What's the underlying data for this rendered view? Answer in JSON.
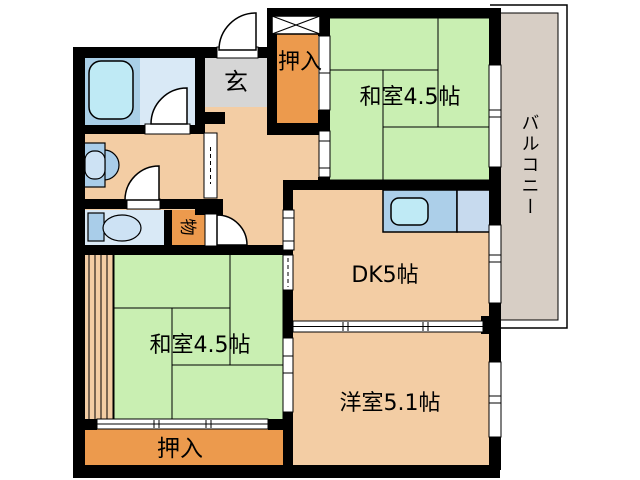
{
  "title": "apartment-floorplan",
  "rooms": {
    "washitsu_top": "和室4.5帖",
    "washitsu_bottom": "和室4.5帖",
    "dk": "DK5帖",
    "western_room": "洋室5.1帖",
    "balcony": "バルコニー",
    "entrance": "玄",
    "closet_top": "押入",
    "closet_bottom": "押入",
    "storage": "物"
  },
  "colors": {
    "wall": "#000000",
    "floor_tan": "#f3cda4",
    "tatami_green": "#c9efb2",
    "closet_orange": "#ec9a4d",
    "entrance_gray": "#d6d6d6",
    "balcony_gray": "#d7cec5",
    "bath_floor": "#a9cfe7",
    "wet_floor": "#d9e9f6",
    "tub_cyan": "#bfeaf5",
    "kitchen_counter": "#accfe9",
    "kitchen_side": "#c7daee",
    "fixture_blue": "#a9cde9",
    "fixture_light": "#cde2f4",
    "opening_white": "#ffffff"
  }
}
